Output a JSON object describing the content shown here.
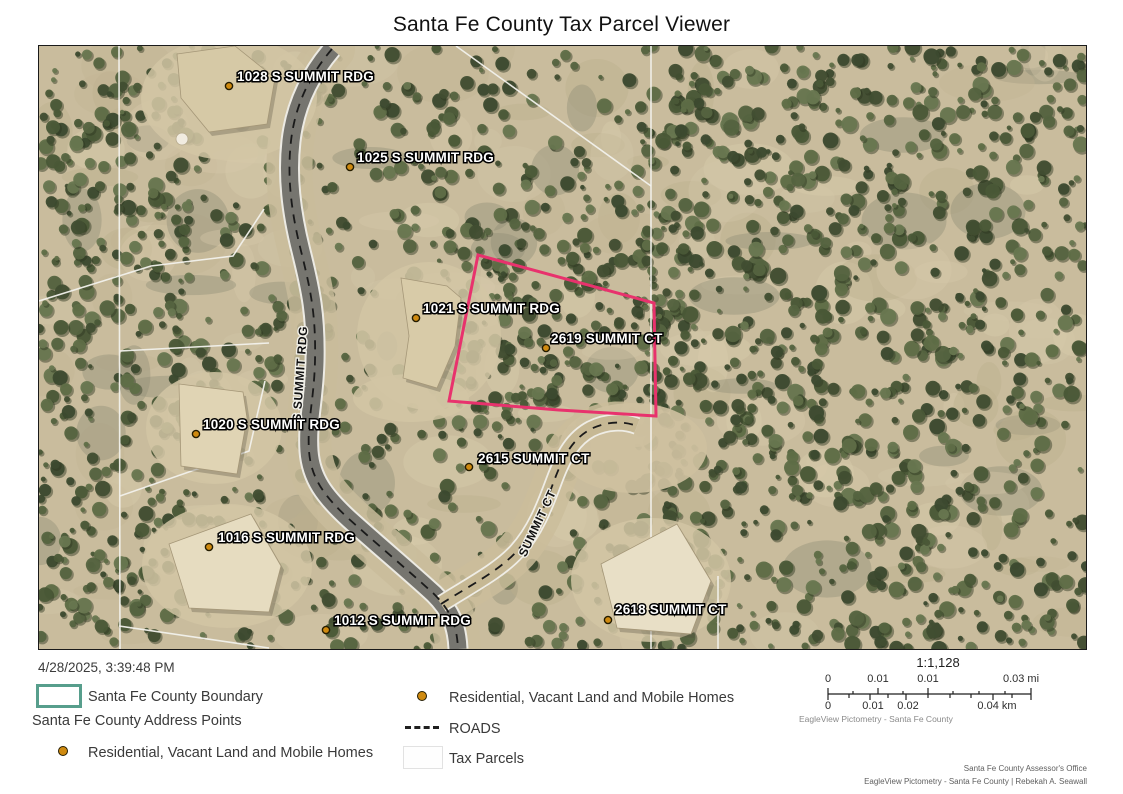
{
  "title": "Santa Fe County Tax Parcel Viewer",
  "colors": {
    "parcel_highlight": "#e8326d",
    "county_boundary": "#579e8c",
    "address_point": "#cf8a10",
    "road_dash": "#1a1a1a"
  },
  "map": {
    "address_points": [
      {
        "label": "1028 S SUMMIT RDG",
        "tx": 198,
        "ty": 35,
        "dx": 190,
        "dy": 40
      },
      {
        "label": "1025 S SUMMIT RDG",
        "tx": 318,
        "ty": 116,
        "dx": 311,
        "dy": 121
      },
      {
        "label": "1021 S SUMMIT RDG",
        "tx": 384,
        "ty": 267,
        "dx": 377,
        "dy": 272
      },
      {
        "label": "2619 SUMMIT CT",
        "tx": 512,
        "ty": 297,
        "dx": 507,
        "dy": 302
      },
      {
        "label": "1020 S SUMMIT RDG",
        "tx": 164,
        "ty": 383,
        "dx": 157,
        "dy": 388
      },
      {
        "label": "2615 SUMMIT CT",
        "tx": 439,
        "ty": 417,
        "dx": 430,
        "dy": 421
      },
      {
        "label": "1016 S SUMMIT RDG",
        "tx": 179,
        "ty": 496,
        "dx": 170,
        "dy": 501
      },
      {
        "label": "1012 S SUMMIT RDG",
        "tx": 295,
        "ty": 579,
        "dx": 287,
        "dy": 584
      },
      {
        "label": "2618 SUMMIT CT",
        "tx": 576,
        "ty": 568,
        "dx": 569,
        "dy": 574
      }
    ],
    "road_labels": [
      {
        "label": "S SUMMIT RDG",
        "x": 265,
        "y": 328,
        "rot": -86
      },
      {
        "label": "SUMMIT CT",
        "x": 502,
        "y": 479,
        "rot": -65
      }
    ]
  },
  "footer": {
    "timestamp": "4/28/2025, 3:39:48 PM",
    "legend": {
      "boundary_label": "Santa Fe County Boundary",
      "address_points_header": "Santa Fe County Address Points",
      "residential_label": "Residential, Vacant Land and Mobile Homes",
      "residential_label_right": "Residential, Vacant Land and Mobile Homes",
      "roads_label": "ROADS",
      "tax_parcels_label": "Tax Parcels"
    },
    "scalebar": {
      "ratio": "1:1,128",
      "mi": [
        "0",
        "0.01",
        "0.01",
        "0.03 mi"
      ],
      "km": [
        "0",
        "0.01",
        "0.02",
        "0.04 km"
      ],
      "credit": "EagleView Pictometry - Santa Fe County"
    },
    "credits": {
      "line1": "Santa Fe County Assessor's Office",
      "line2": "EagleView Pictometry - Santa Fe County | Rebekah A. Seawall"
    }
  }
}
